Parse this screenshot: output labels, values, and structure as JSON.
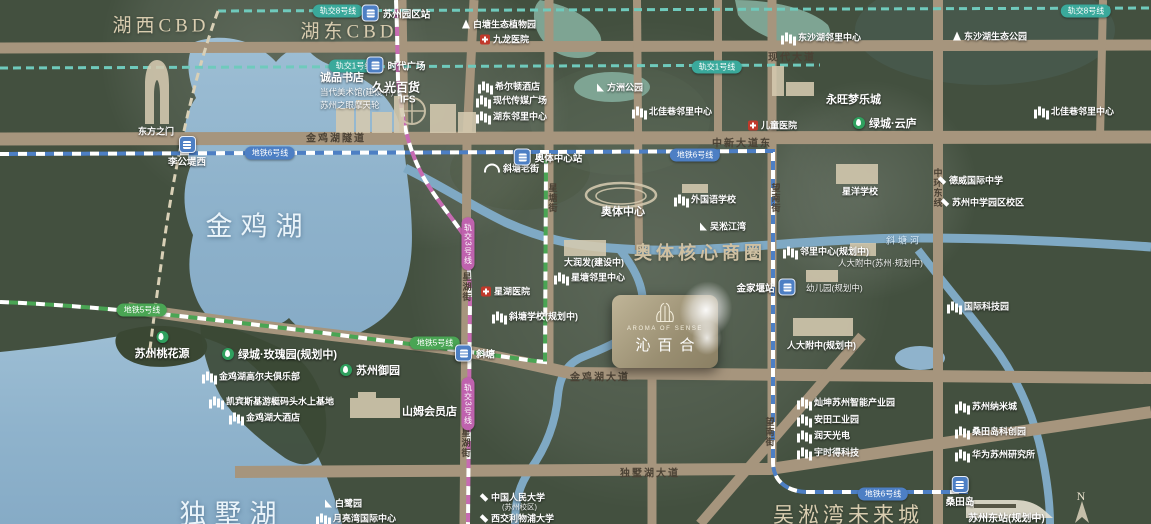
{
  "map": {
    "colors": {
      "land": "#43503f",
      "road": "#a6957d",
      "water": "#8fb3cc",
      "line_teal": "#6fcabc",
      "line_blue": "#4d7fc4",
      "line_green": "#4aa554",
      "line_magenta": "#c76bb2",
      "accent_tan": "#d9cdb0",
      "greentown_green": "#2fa05e",
      "medical_red": "#c0392b"
    },
    "compass_n": "N",
    "logo_card": {
      "en": "AROMA OF SENSE",
      "cn": "沁百合"
    },
    "area_labels": [
      {
        "t": "湖西CBD",
        "x": 161,
        "y": 24,
        "size": 19
      },
      {
        "t": "湖东CBD",
        "x": 349,
        "y": 30,
        "size": 19
      },
      {
        "t": "奥体核心商圈",
        "x": 700,
        "y": 252,
        "size": 18,
        "bold": true
      },
      {
        "t": "吴淞湾未来城",
        "x": 848,
        "y": 514,
        "size": 21
      }
    ],
    "lake_labels": [
      {
        "t": "金鸡湖",
        "x": 258,
        "y": 224,
        "size": 27
      },
      {
        "t": "独墅湖",
        "x": 232,
        "y": 512,
        "size": 27
      }
    ],
    "road_labels_h": [
      {
        "t": "现代大道",
        "x": 768,
        "y": 56
      },
      {
        "t": "金鸡湖隧道",
        "x": 306,
        "y": 137
      },
      {
        "t": "中新大道东",
        "x": 712,
        "y": 142
      },
      {
        "t": "金鸡湖大道",
        "x": 570,
        "y": 376
      },
      {
        "t": "独墅湖大道",
        "x": 620,
        "y": 472
      }
    ],
    "road_labels_v": [
      {
        "t": "星塘街",
        "x": 553,
        "y": 183
      },
      {
        "t": "星湖街",
        "x": 467,
        "y": 272
      },
      {
        "t": "星湖街",
        "x": 466,
        "y": 428
      },
      {
        "t": "望南街",
        "x": 776,
        "y": 183
      },
      {
        "t": "望南街",
        "x": 770,
        "y": 417
      },
      {
        "t": "中环东线",
        "x": 938,
        "y": 168
      }
    ],
    "river_labels": [
      {
        "t": "斜塘河",
        "x": 886,
        "y": 240
      }
    ],
    "metro_pills": [
      {
        "t": "轨交8号线",
        "x": 338,
        "y": 11,
        "line": "l8"
      },
      {
        "t": "轨交8号线",
        "x": 1086,
        "y": 11,
        "line": "l8"
      },
      {
        "t": "轨交1号线",
        "x": 354,
        "y": 66,
        "line": "l1"
      },
      {
        "t": "轨交1号线",
        "x": 717,
        "y": 67,
        "line": "l1"
      },
      {
        "t": "地铁6号线",
        "x": 270,
        "y": 153,
        "line": "l6"
      },
      {
        "t": "地铁6号线",
        "x": 695,
        "y": 155,
        "line": "l6"
      },
      {
        "t": "地铁6号线",
        "x": 883,
        "y": 494,
        "line": "l6"
      },
      {
        "t": "地铁5号线",
        "x": 142,
        "y": 310,
        "line": "l5"
      },
      {
        "t": "地铁5号线",
        "x": 435,
        "y": 343,
        "line": "l5"
      },
      {
        "t": "轨交3号线",
        "x": 468,
        "y": 244,
        "line": "l3",
        "v": true
      },
      {
        "t": "轨交3号线",
        "x": 468,
        "y": 404,
        "line": "l3",
        "v": true
      }
    ],
    "stations": [
      {
        "t": "苏州园区站",
        "x": 396,
        "y": 13,
        "pos": "right"
      },
      {
        "t": "时代广场",
        "x": 396,
        "y": 65,
        "pos": "right"
      },
      {
        "t": "李公堤西",
        "x": 187,
        "y": 152,
        "pos": "below"
      },
      {
        "t": "奥体中心站",
        "x": 548,
        "y": 157,
        "pos": "right"
      },
      {
        "t": "金家堰站",
        "x": 766,
        "y": 287,
        "pos": "left"
      },
      {
        "t": "斜塘",
        "x": 475,
        "y": 353,
        "pos": "right"
      },
      {
        "t": "桑田岛",
        "x": 960,
        "y": 492,
        "pos": "below"
      }
    ],
    "green_pois": [
      {
        "t": "苏州桃花源",
        "x": 162,
        "y": 346,
        "stack": true
      },
      {
        "t": "绿城·玫瑰园(规划中)",
        "x": 222,
        "y": 354
      },
      {
        "t": "苏州御园",
        "x": 340,
        "y": 370
      },
      {
        "t": "绿城·云庐",
        "x": 853,
        "y": 123
      }
    ],
    "pois": [
      {
        "t": "白塘生态植物园",
        "x": 462,
        "y": 24,
        "icon": "tree"
      },
      {
        "t": "九龙医院",
        "x": 480,
        "y": 39,
        "icon": "cross"
      },
      {
        "t": "希尔顿酒店",
        "x": 478,
        "y": 86,
        "icon": "building"
      },
      {
        "t": "现代传媒广场",
        "x": 476,
        "y": 100,
        "icon": "building"
      },
      {
        "t": "湖东邻里中心",
        "x": 476,
        "y": 116,
        "icon": "building"
      },
      {
        "t": "方洲公园",
        "x": 597,
        "y": 87,
        "icon": "sail"
      },
      {
        "t": "北佳巷邻里中心",
        "x": 632,
        "y": 111,
        "icon": "building"
      },
      {
        "t": "东沙湖邻里中心",
        "x": 781,
        "y": 37,
        "icon": "building"
      },
      {
        "t": "东沙湖生态公园",
        "x": 953,
        "y": 36,
        "icon": "tree"
      },
      {
        "t": "永旺梦乐城",
        "x": 826,
        "y": 99,
        "icon": "none",
        "size": 11
      },
      {
        "t": "儿童医院",
        "x": 748,
        "y": 125,
        "icon": "cross"
      },
      {
        "t": "北佳巷邻里中心",
        "x": 1034,
        "y": 111,
        "icon": "building"
      },
      {
        "t": "诚品书店",
        "x": 320,
        "y": 77,
        "icon": "none",
        "size": 11
      },
      {
        "t": "当代美术馆(建设中)",
        "x": 320,
        "y": 92,
        "icon": "none",
        "dim": true
      },
      {
        "t": "苏州之眼摩天轮",
        "x": 320,
        "y": 105,
        "icon": "none",
        "dim": true
      },
      {
        "t": "久光百货",
        "x": 372,
        "y": 87,
        "icon": "none",
        "size": 12
      },
      {
        "t": "IFS",
        "x": 400,
        "y": 100,
        "icon": "none",
        "size": 10
      },
      {
        "t": "东方之门",
        "x": 138,
        "y": 131,
        "icon": "none"
      },
      {
        "t": "斜塘老街",
        "x": 484,
        "y": 168,
        "icon": "bridge"
      },
      {
        "t": "奥体中心",
        "x": 601,
        "y": 211,
        "icon": "none",
        "size": 11
      },
      {
        "t": "外国语学校",
        "x": 674,
        "y": 199,
        "icon": "building"
      },
      {
        "t": "吴淞江湾",
        "x": 700,
        "y": 226,
        "icon": "sail"
      },
      {
        "t": "大润发(建设中)",
        "x": 564,
        "y": 262,
        "icon": "none"
      },
      {
        "t": "星塘邻里中心",
        "x": 554,
        "y": 277,
        "icon": "building"
      },
      {
        "t": "星湖医院",
        "x": 481,
        "y": 291,
        "icon": "cross"
      },
      {
        "t": "斜塘学校(规划中)",
        "x": 492,
        "y": 316,
        "icon": "building"
      },
      {
        "t": "邻里中心(规划中)",
        "x": 783,
        "y": 251,
        "icon": "building"
      },
      {
        "t": "人大附中(苏州·规划中)",
        "x": 838,
        "y": 263,
        "icon": "none",
        "dim": true
      },
      {
        "t": "幼儿园(规划中)",
        "x": 806,
        "y": 288,
        "icon": "none",
        "dim": true
      },
      {
        "t": "人大附中(规划中)",
        "x": 787,
        "y": 345,
        "icon": "none"
      },
      {
        "t": "星洋学校",
        "x": 842,
        "y": 191,
        "icon": "none"
      },
      {
        "t": "德威国际中学",
        "x": 938,
        "y": 180,
        "icon": "school"
      },
      {
        "t": "苏州中学园区校区",
        "x": 941,
        "y": 202,
        "icon": "school"
      },
      {
        "t": "国际科技园",
        "x": 947,
        "y": 306,
        "icon": "building"
      },
      {
        "t": "金鸡湖高尔夫俱乐部",
        "x": 202,
        "y": 376,
        "icon": "building"
      },
      {
        "t": "凯宾斯基游艇码头水上基地",
        "x": 209,
        "y": 401,
        "icon": "building"
      },
      {
        "t": "金鸡湖大酒店",
        "x": 229,
        "y": 417,
        "icon": "building"
      },
      {
        "t": "山姆会员店",
        "x": 402,
        "y": 411,
        "icon": "none",
        "size": 11
      },
      {
        "t": "白鹭园",
        "x": 325,
        "y": 503,
        "icon": "sail"
      },
      {
        "t": "月亮湾国际中心",
        "x": 316,
        "y": 518,
        "icon": "building"
      },
      {
        "t": "中国人民大学",
        "x": 480,
        "y": 497,
        "icon": "school"
      },
      {
        "t": "(苏州校区)",
        "x": 502,
        "y": 507,
        "icon": "none",
        "dim": true,
        "size": 7.5
      },
      {
        "t": "西交利物浦大学",
        "x": 480,
        "y": 518,
        "icon": "school"
      },
      {
        "t": "灿坤苏州智能产业园",
        "x": 797,
        "y": 402,
        "icon": "building"
      },
      {
        "t": "安田工业园",
        "x": 797,
        "y": 419,
        "icon": "building"
      },
      {
        "t": "润天光电",
        "x": 797,
        "y": 435,
        "icon": "building"
      },
      {
        "t": "宇时得科技",
        "x": 797,
        "y": 452,
        "icon": "building"
      },
      {
        "t": "苏州纳米城",
        "x": 955,
        "y": 406,
        "icon": "building"
      },
      {
        "t": "桑田岛科创园",
        "x": 955,
        "y": 431,
        "icon": "building"
      },
      {
        "t": "华为苏州研究所",
        "x": 955,
        "y": 454,
        "icon": "building"
      },
      {
        "t": "苏州东站(规划中)",
        "x": 968,
        "y": 517,
        "icon": "none",
        "size": 10
      }
    ]
  }
}
